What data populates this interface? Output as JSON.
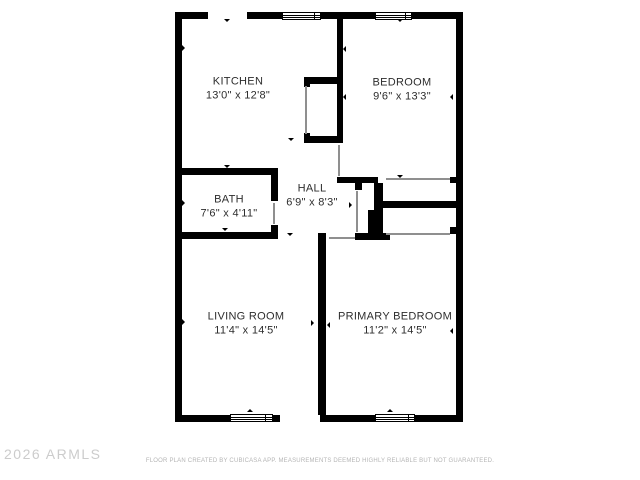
{
  "page": {
    "type": "floor-plan",
    "colors": {
      "background": "#ffffff",
      "walls": "#000000",
      "room_text": "#2d2d2d",
      "door_lines": "#8f8f8f",
      "watermark_text": "#cccccc",
      "disclaimer_text": "#b5b5b5"
    }
  },
  "floorplan": {
    "rooms": [
      {
        "id": "kitchen",
        "name": "KITCHEN",
        "dims": "13'0\" x 12'8\""
      },
      {
        "id": "bedroom",
        "name": "BEDROOM",
        "dims": "9'6\" x 13'3\""
      },
      {
        "id": "bath",
        "name": "BATH",
        "dims": "7'6\" x 4'11\""
      },
      {
        "id": "hall",
        "name": "HALL",
        "dims": "6'9\" x 8'3\""
      },
      {
        "id": "living-room",
        "name": "LIVING ROOM",
        "dims": "11'4\" x 14'5\""
      },
      {
        "id": "primary-bedroom",
        "name": "PRIMARY BEDROOM",
        "dims": "11'2\" x 14'5\""
      }
    ]
  },
  "footer": {
    "watermark": "2026 ARMLS",
    "disclaimer": "FLOOR PLAN CREATED BY CUBICASA APP. MEASUREMENTS DEEMED HIGHLY RELIABLE BUT NOT GUARANTEED."
  }
}
